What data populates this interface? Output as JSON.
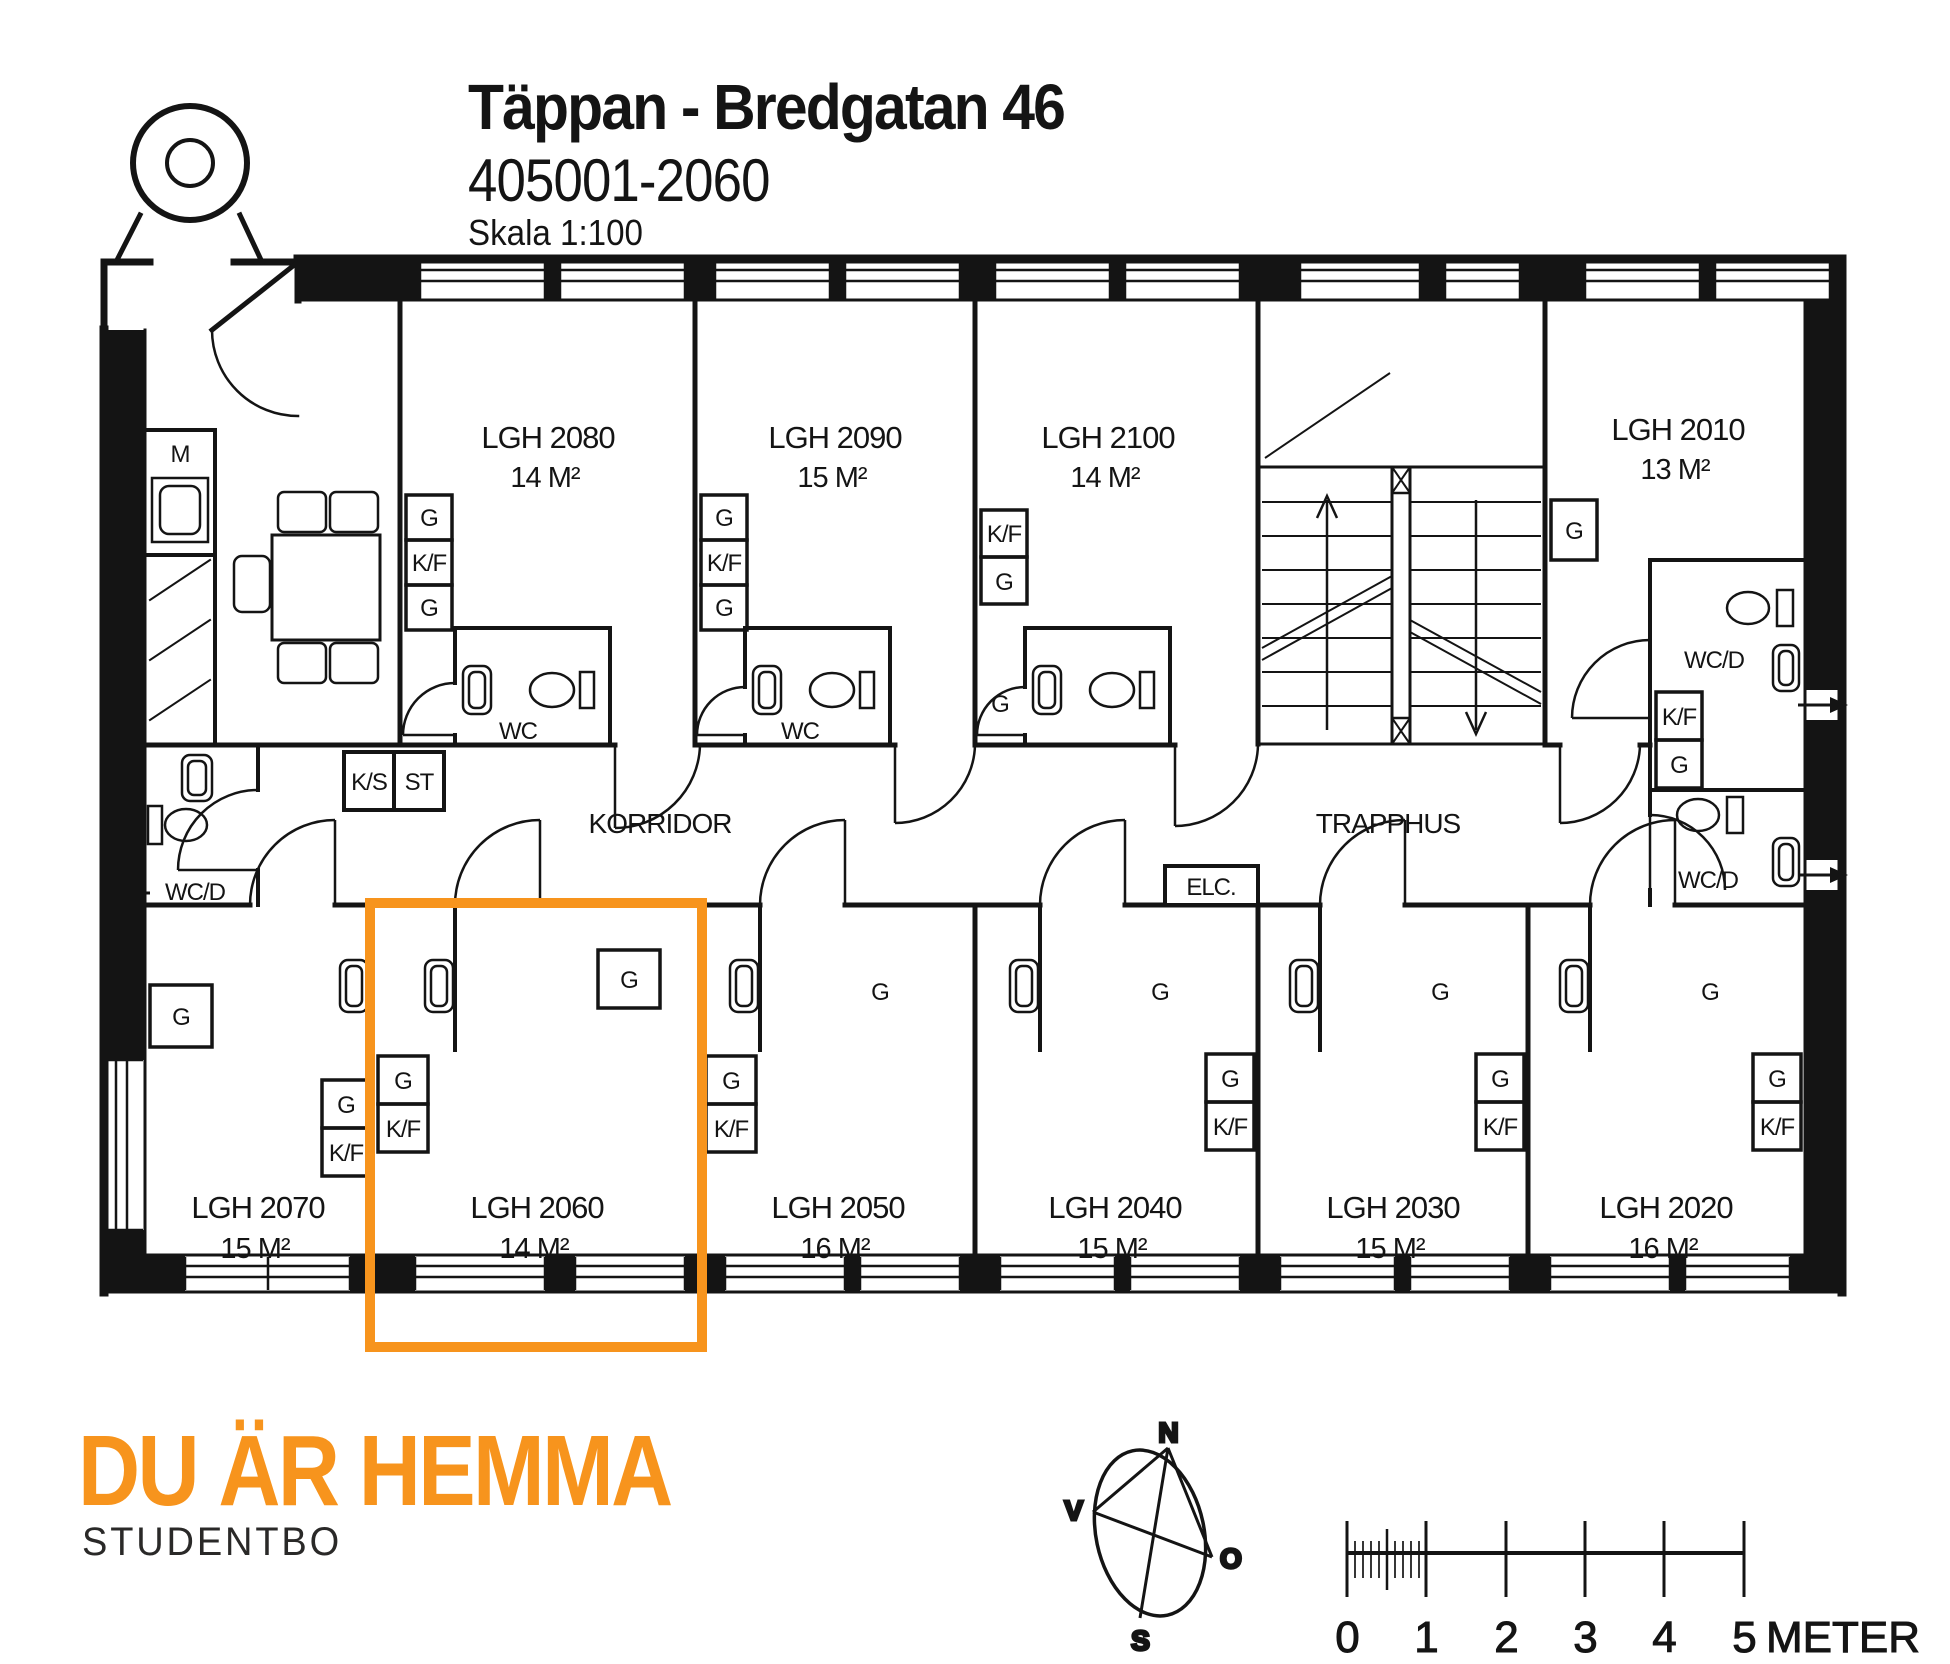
{
  "header": {
    "title": "Täppan - Bredgatan 46",
    "code": "405001-2060",
    "scale": "Skala 1:100"
  },
  "plan": {
    "corridor": "KORRIDOR",
    "stairwell": "TRAPPHUS",
    "electrical": "ELC.",
    "labels": {
      "g": "G",
      "kf": "K/F",
      "ks": "K/S",
      "st": "ST",
      "m": "M",
      "wc": "WC",
      "wcd": "WC/D"
    },
    "apartments": [
      {
        "name": "LGH 2080",
        "area": "14 M²"
      },
      {
        "name": "LGH 2090",
        "area": "15 M²"
      },
      {
        "name": "LGH 2100",
        "area": "14 M²"
      },
      {
        "name": "LGH 2010",
        "area": "13 M²"
      },
      {
        "name": "LGH 2070",
        "area": "15 M²"
      },
      {
        "name": "LGH 2060",
        "area": "14 M²"
      },
      {
        "name": "LGH 2050",
        "area": "16 M²"
      },
      {
        "name": "LGH 2040",
        "area": "15 M²"
      },
      {
        "name": "LGH 2030",
        "area": "15 M²"
      },
      {
        "name": "LGH 2020",
        "area": "16 M²"
      }
    ],
    "highlight": {
      "apartment": "LGH 2060",
      "color": "#F7941D"
    }
  },
  "compass": {
    "north": "N",
    "south": "S",
    "west": "V",
    "east": "O"
  },
  "scale_bar": {
    "ticks": [
      "0",
      "1",
      "2",
      "3",
      "4",
      "5"
    ],
    "unit": "METER"
  },
  "footer": {
    "logo": "DU ÄR HEMMA",
    "sub": "STUDENTBO",
    "logo_color": "#F7941D",
    "sub_color": "#2A2928"
  }
}
